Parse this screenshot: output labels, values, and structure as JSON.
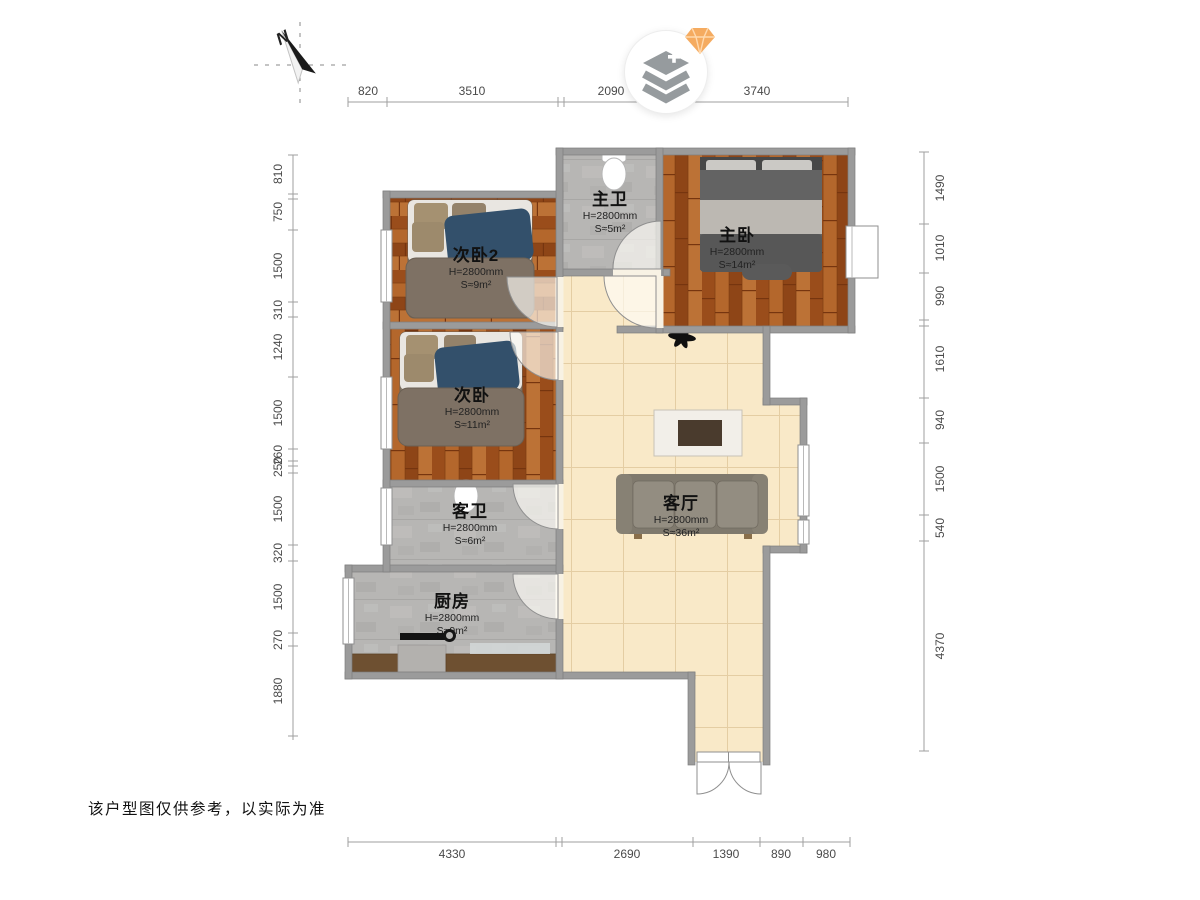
{
  "meta": {
    "disclaimer": "该户型图仅供参考，以实际为准",
    "compass_label": "N"
  },
  "dimensions": {
    "top": [
      "820",
      "3510",
      "2090",
      "3740"
    ],
    "bottom": [
      "4330",
      "2690",
      "1390",
      "890",
      "980"
    ],
    "left": [
      "810",
      "750",
      "1500",
      "310",
      "1240",
      "1500",
      "260",
      "250",
      "1500",
      "320",
      "1500",
      "270",
      "1880"
    ],
    "right": [
      "1490",
      "1010",
      "990",
      "1610",
      "940",
      "1500",
      "540",
      "4370"
    ]
  },
  "rooms": [
    {
      "name": "次卧2",
      "height": "H=2800mm",
      "area": "S≈9m²"
    },
    {
      "name": "主卫",
      "height": "H=2800mm",
      "area": "S≈5m²"
    },
    {
      "name": "主卧",
      "height": "H=2800mm",
      "area": "S≈14m²"
    },
    {
      "name": "次卧",
      "height": "H=2800mm",
      "area": "S≈11m²"
    },
    {
      "name": "客卫",
      "height": "H=2800mm",
      "area": "S≈6m²"
    },
    {
      "name": "客厅",
      "height": "H=2800mm",
      "area": "S≈36m²"
    },
    {
      "name": "厨房",
      "height": "H=2800mm",
      "area": "S≈9m²"
    }
  ],
  "colors": {
    "wall": "#9b9b9b",
    "wood": "#a85a22",
    "tile_gray": "#b7b6b4",
    "tile_cream": "#f9e9c8",
    "gem_orange": "#f5ab60"
  }
}
